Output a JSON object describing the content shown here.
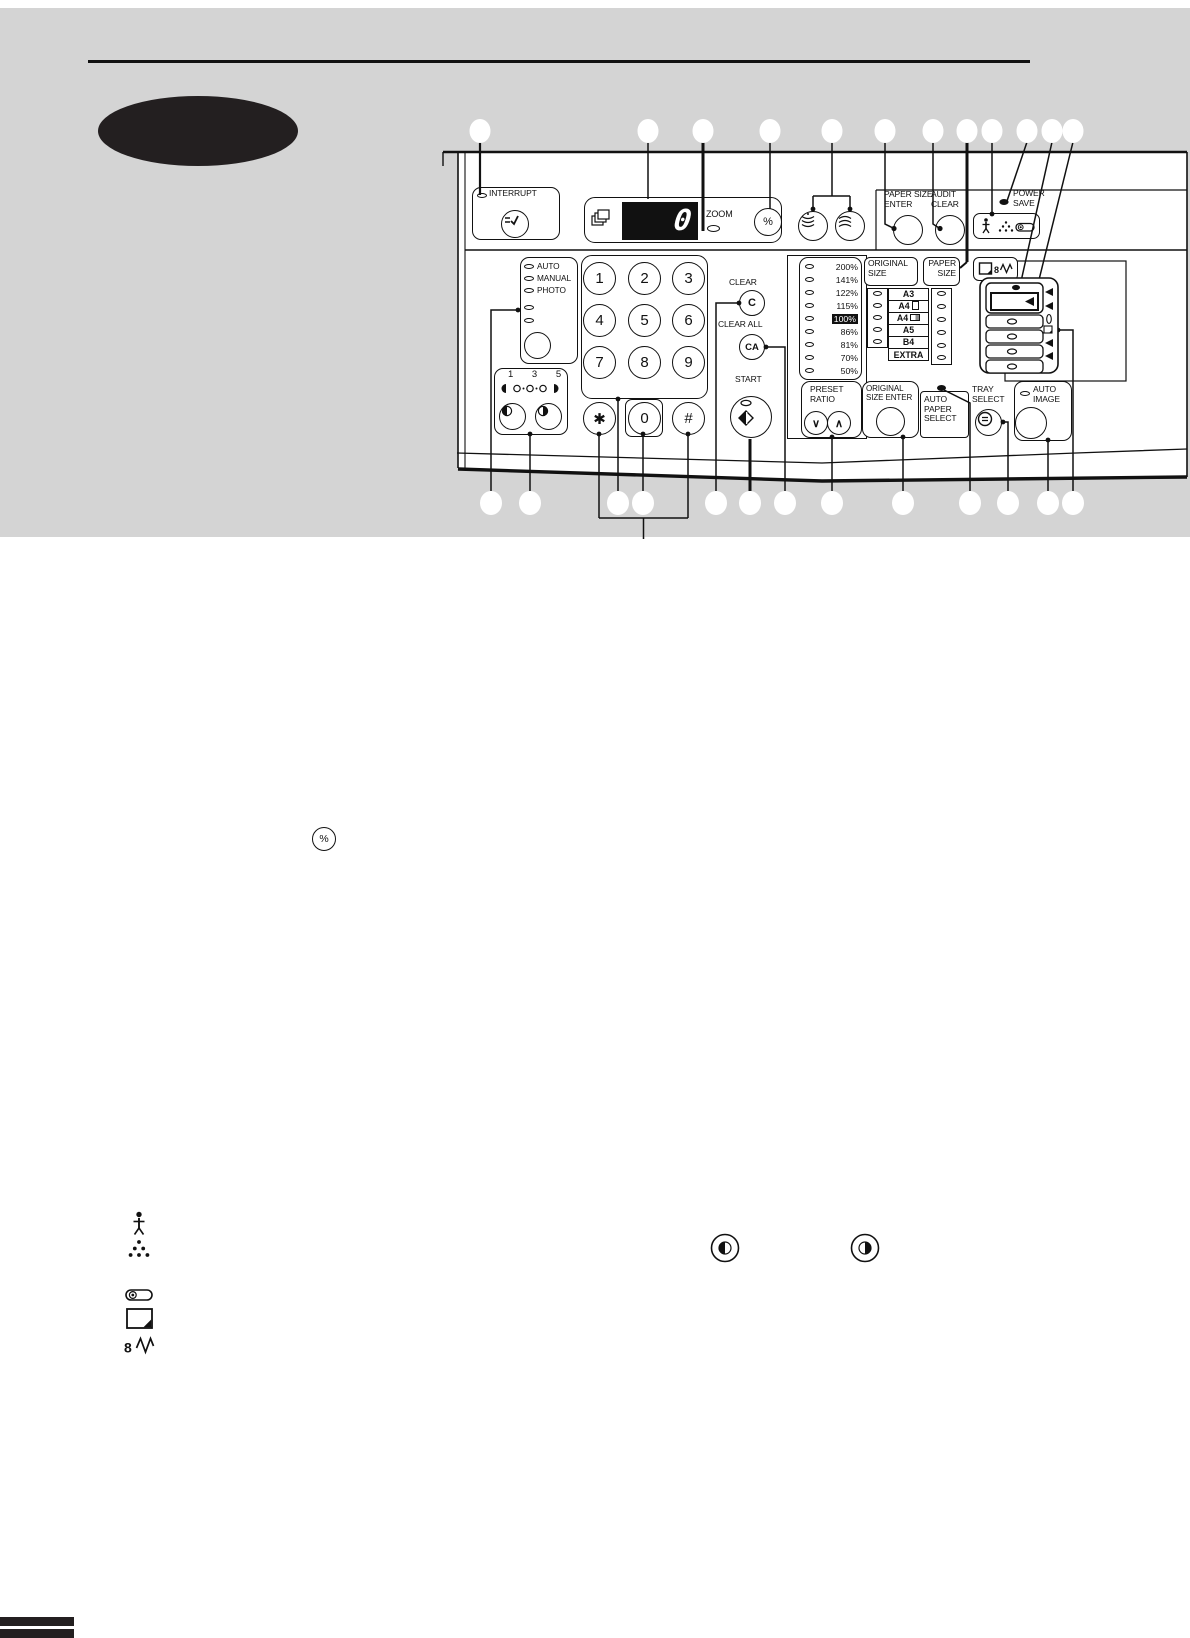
{
  "colors": {
    "band": "#d4d4d4",
    "ink": "#111111",
    "oval": "#231f20"
  },
  "panel": {
    "interrupt": {
      "label": "INTERRUPT"
    },
    "display": {
      "copies_value": "0",
      "zoom_label": "ZOOM",
      "percent_label": "%"
    },
    "paper_size_enter_label": "PAPER SIZE\nENTER",
    "audit_clear_label": "AUDIT\nCLEAR",
    "power_save_label": "POWER\nSAVE",
    "exposure_mode": {
      "labels": [
        "AUTO",
        "MANUAL",
        "PHOTO"
      ]
    },
    "exposure_adjust": {
      "scale": "1 3 5"
    },
    "keypad": {
      "keys": [
        "1",
        "2",
        "3",
        "4",
        "5",
        "6",
        "7",
        "8",
        "9",
        "✱",
        "0",
        "#"
      ]
    },
    "clear": {
      "label": "CLEAR",
      "key": "C"
    },
    "clear_all": {
      "label": "CLEAR ALL",
      "key": "CA"
    },
    "start": {
      "label": "START"
    },
    "preset_ratio": {
      "label": "PRESET\nRATIO",
      "down_glyph": "∨",
      "up_glyph": "∧",
      "ratios": [
        "200%",
        "141%",
        "122%",
        "115%",
        "100%",
        "86%",
        "81%",
        "70%",
        "50%"
      ],
      "active_ratio": "100%"
    },
    "size_table": {
      "original_size_label": "ORIGINAL\nSIZE",
      "paper_size_label": "PAPER\nSIZE",
      "sizes": [
        "A3",
        "A4",
        "A4",
        "A5",
        "B4",
        "EXTRA"
      ]
    },
    "original_size_enter_label": "ORIGINAL\nSIZE ENTER",
    "auto_paper_select_label": "AUTO\nPAPER\nSELECT",
    "tray_select_label": "TRAY\nSELECT",
    "auto_image_label": "AUTO\nIMAGE"
  },
  "icons": {
    "percent_key": "%",
    "misfeed_glyph": "8"
  }
}
